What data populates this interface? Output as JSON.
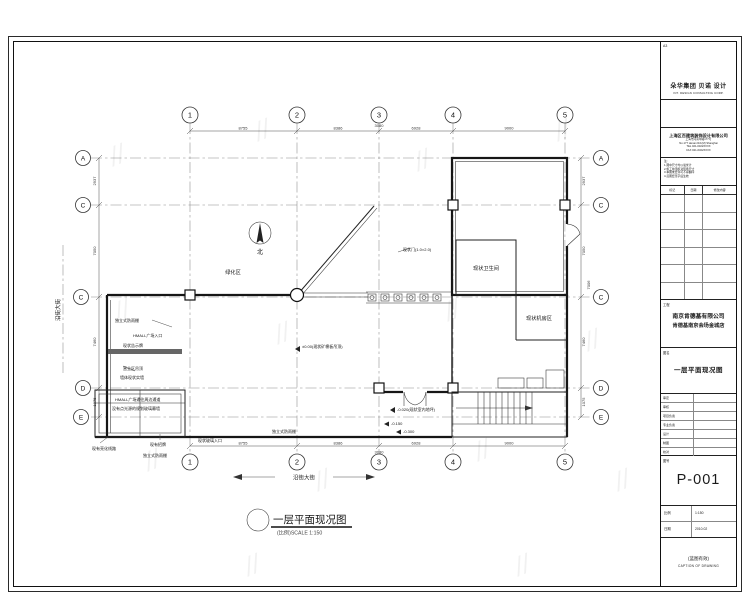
{
  "watermark": {
    "glyph": "//"
  },
  "title_block": {
    "sheet_size": "A3",
    "brand_cn": "朵华集团 贝诺 设计",
    "brand_en": "INT. DESIGN CONSULTING CORP.",
    "firm_lines": {
      "main": "上海区百建筑装饰设计有限公司",
      "addr": "上海市河南中路177号",
      "addr_en": "No.177 Henan Rd.(M) Shanghai",
      "tel": "TEL 021-6322XXXX",
      "fax": "FAX 021-6322XXXX"
    },
    "notes": {
      "n0": "注:",
      "n1": "1.图中尺寸均以毫米计",
      "n2": "2.施工前须核对现场尺寸",
      "n3": "3.本图未经许可不得翻印",
      "n4": "4.蓝图经签字后生效"
    },
    "rev_headers": {
      "mark": "标记",
      "date": "日期",
      "desc": "修改内容"
    },
    "project_label": "工程",
    "client": "南京肯德基有限公司",
    "project": "肯德基南京会场金城店",
    "drawing_label": "图名",
    "drawing_title": "一层平面现况图",
    "staff": [
      "审定",
      "审核",
      "项目负责",
      "专业负责",
      "设计",
      "制图",
      "校对"
    ],
    "drawing_no_label": "图号",
    "drawing_no": "P-001",
    "scale_label": "比例",
    "scale_value": "1:150",
    "date_label": "日期",
    "date_value": "2010.02",
    "footer_cn": "(蓝图有效)",
    "footer_en": "CAPTION OF DRAWING"
  },
  "plan": {
    "grid": {
      "cols": [
        "1",
        "2",
        "3",
        "4",
        "5"
      ],
      "rows": [
        "A",
        "C",
        "C",
        "D",
        "E"
      ]
    },
    "dims": {
      "top": [
        "8755",
        "8386",
        "6928",
        "9000"
      ],
      "bottom": [
        "8755",
        "8386",
        "6928",
        "9000"
      ],
      "left": [
        "2937",
        "7050",
        "7460",
        "1075"
      ],
      "right": [
        "2937",
        "7050",
        "7460",
        "1075"
      ],
      "right_extra": "7006",
      "small_top": "3080",
      "small_bottom": "3080"
    },
    "labels": {
      "north": "北",
      "green_area": "绿化区",
      "toilet": "现状卫生间",
      "machine_room": "现状机房区"
    },
    "annotations": {
      "canopy": "独立式防雨棚",
      "entrance": "HMALL广场入口",
      "board": "现状告示牌",
      "ceiling": "营业区吊顶",
      "wall": "墙体现状实墙",
      "passage1": "HMALL广场通往周边通道",
      "passage2": "没有点光源的规划玻璃幕墙",
      "lighting": "现有亮化线路",
      "sign": "现有招牌",
      "canopy2": "独立式防雨棚",
      "glass_entry": "现状玻璃入口",
      "canopy3": "独立式防雨棚",
      "door": "现状门(1.0×2.0)",
      "level_zero": "±0.00(现状矿棉板吊顶)",
      "level_inner": "-0.020(现状室内地坪)",
      "level_15": "-0.150",
      "level_30": "-0.300"
    },
    "street": "沿街大街",
    "caption": {
      "title": "一层平面现况图",
      "scale": "(比例)SCALE 1:150"
    }
  }
}
